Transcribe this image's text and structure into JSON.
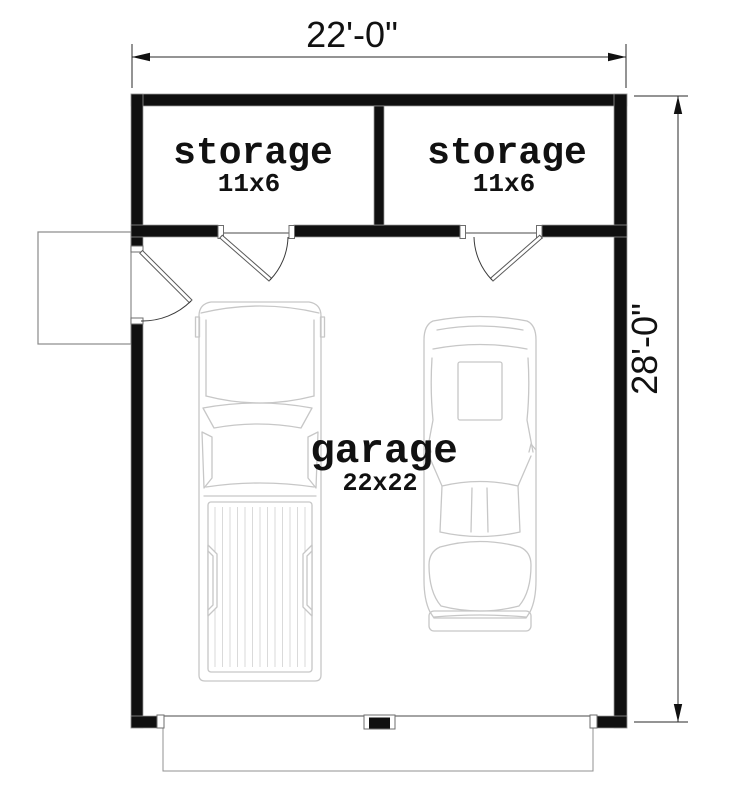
{
  "floor_plan": {
    "overall_dimensions": {
      "width_label": "22'-0\"",
      "height_label": "28'-0\""
    },
    "rooms": {
      "storage_left": {
        "label": "storage",
        "size": "11x6"
      },
      "storage_right": {
        "label": "storage",
        "size": "11x6"
      },
      "garage": {
        "label": "garage",
        "size": "22x22"
      }
    },
    "features": [
      "entry-door-left-wall",
      "storage-door-left",
      "storage-door-right",
      "double-garage-door-opening",
      "driveway-apron",
      "side-stoop",
      "pickup-truck-parked",
      "car-parked"
    ],
    "colors": {
      "background": "#ffffff",
      "wall": "#101010",
      "vehicle_outline": "#c7c7c7",
      "dimension_line": "#2a2a2a",
      "text": "#111111"
    }
  }
}
